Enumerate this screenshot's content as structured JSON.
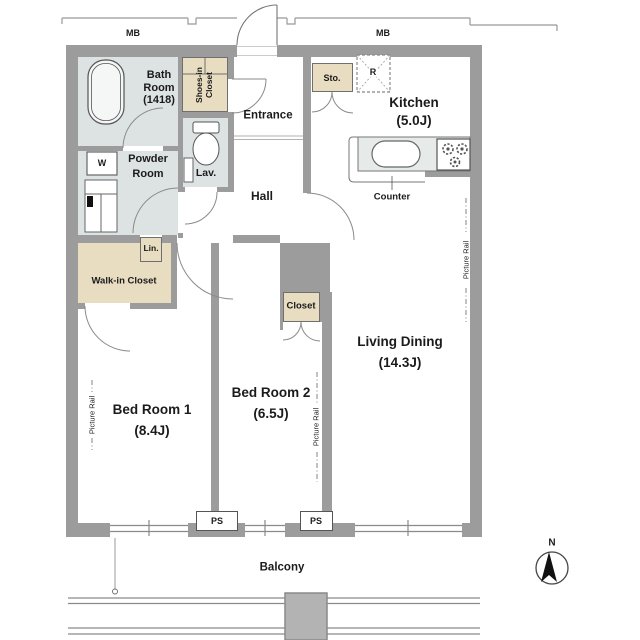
{
  "rooms": {
    "bath": {
      "line1": "Bath",
      "line2": "Room",
      "line3": "(1418)"
    },
    "powder": {
      "line1": "Powder",
      "line2": "Room"
    },
    "lav": "Lav.",
    "entrance": "Entrance",
    "hall": "Hall",
    "kitchen": {
      "name": "Kitchen",
      "size": "(5.0J)"
    },
    "living": {
      "name": "Living Dining",
      "size": "(14.3J)"
    },
    "bed1": {
      "name": "Bed Room 1",
      "size": "(8.4J)"
    },
    "bed2": {
      "name": "Bed Room 2",
      "size": "(6.5J)"
    },
    "balcony": "Balcony"
  },
  "storage": {
    "shoes": {
      "line1": "Shoes-in",
      "line2": "Closet"
    },
    "sto": "Sto.",
    "lin": "Lin.",
    "walkin": "Walk-in Closet",
    "closet": "Closet"
  },
  "fixtures": {
    "washer": "W",
    "fridge": "R",
    "counter": "Counter"
  },
  "annotations": {
    "mb": "MB",
    "ps": "PS",
    "picture_rail": "Picture Rail",
    "north": "N"
  },
  "colors": {
    "wall": "#9c9c9c",
    "wet_room": "#dce3e2",
    "closet_fill": "#e8dcc1",
    "outline": "#6f6f6f"
  }
}
